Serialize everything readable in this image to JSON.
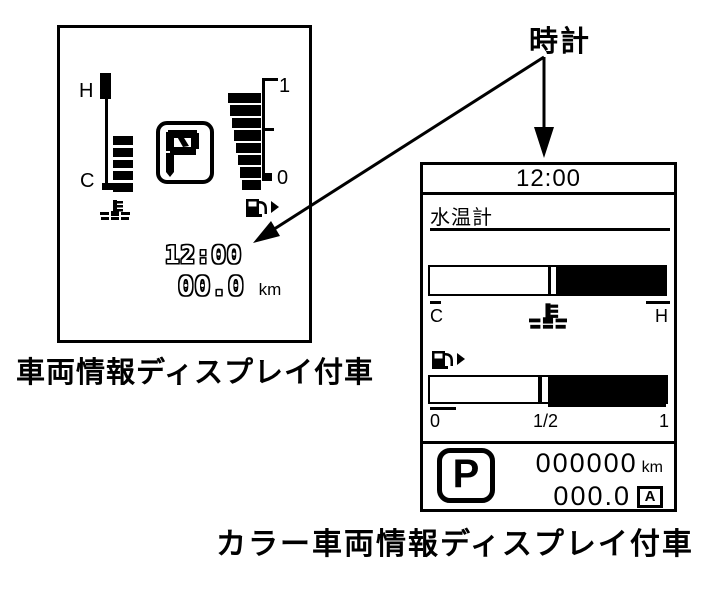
{
  "colors": {
    "ink": "#000000",
    "bg": "#ffffff"
  },
  "callout": {
    "label": "時計"
  },
  "mono_display": {
    "caption": "車両情報ディスプレイ付車",
    "temp_gauge": {
      "top_label": "H",
      "bottom_label": "C",
      "segments": 5
    },
    "fuel_gauge": {
      "top_label": "1",
      "bottom_label": "0",
      "segments": 8
    },
    "shift_indicator": "P",
    "clock": "12:00",
    "trip": {
      "value": "00.0",
      "unit": "km"
    }
  },
  "color_display": {
    "caption": "カラー車両情報ディスプレイ付車",
    "clock": "12:00",
    "title": "水温計",
    "temp_gauge": {
      "left_label": "C",
      "right_label": "H",
      "fill_percent": 50
    },
    "fuel_gauge": {
      "tick_labels": [
        "0",
        "1/2",
        "1"
      ],
      "fill_percent": 50
    },
    "shift_indicator": "P",
    "odometer": {
      "value": "000000",
      "unit": "km"
    },
    "trip": {
      "value": "000.0",
      "mode": "A"
    }
  }
}
